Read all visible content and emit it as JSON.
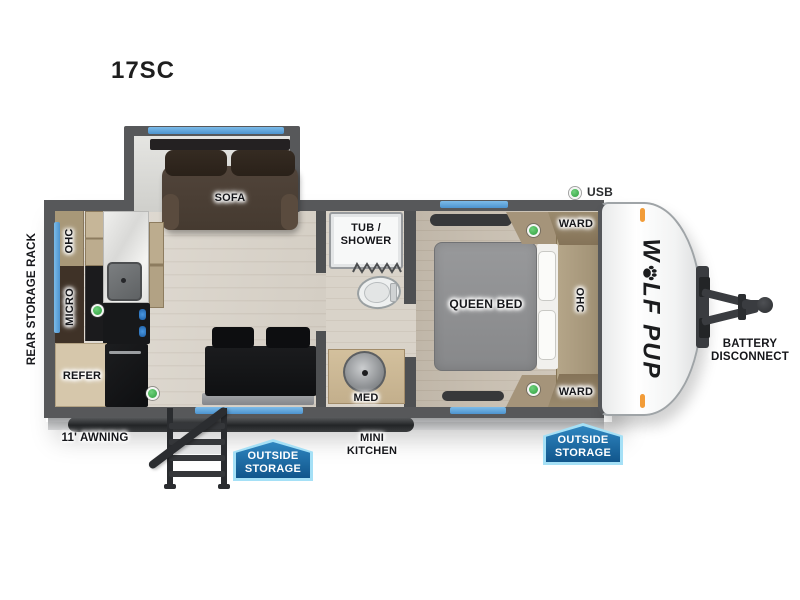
{
  "title": "17SC",
  "legend": {
    "usb": "USB"
  },
  "logo": {
    "first": "W",
    "rest": "LF PUP"
  },
  "labels": {
    "rear_storage_rack": "REAR STORAGE RACK",
    "ohc_kitchen": "OHC",
    "micro": "MICRO",
    "refer": "REFER",
    "sofa": "SOFA",
    "tub_shower": [
      "TUB /",
      "SHOWER"
    ],
    "med": "MED",
    "queen_bed": "QUEEN BED",
    "ward_top": "WARD",
    "ward_bottom": "WARD",
    "ohc_bedroom": "OHC",
    "awning": "11' AWNING",
    "mini_kitchen": [
      "MINI",
      "KITCHEN"
    ],
    "battery_disconnect": [
      "BATTERY",
      "DISCONNECT"
    ]
  },
  "badges": {
    "outside_storage_left": {
      "line1": "OUTSIDE",
      "line2": "STORAGE"
    },
    "outside_storage_right": {
      "line1": "OUTSIDE",
      "line2": "STORAGE"
    }
  },
  "colors": {
    "window_blue": "#5da4dc",
    "badge_blue": "#1d6fae",
    "badge_border": "#a5e0f6",
    "usb_green": "#3db54a",
    "marker_orange": "#f29c38",
    "wall_gray": "#57585a"
  }
}
